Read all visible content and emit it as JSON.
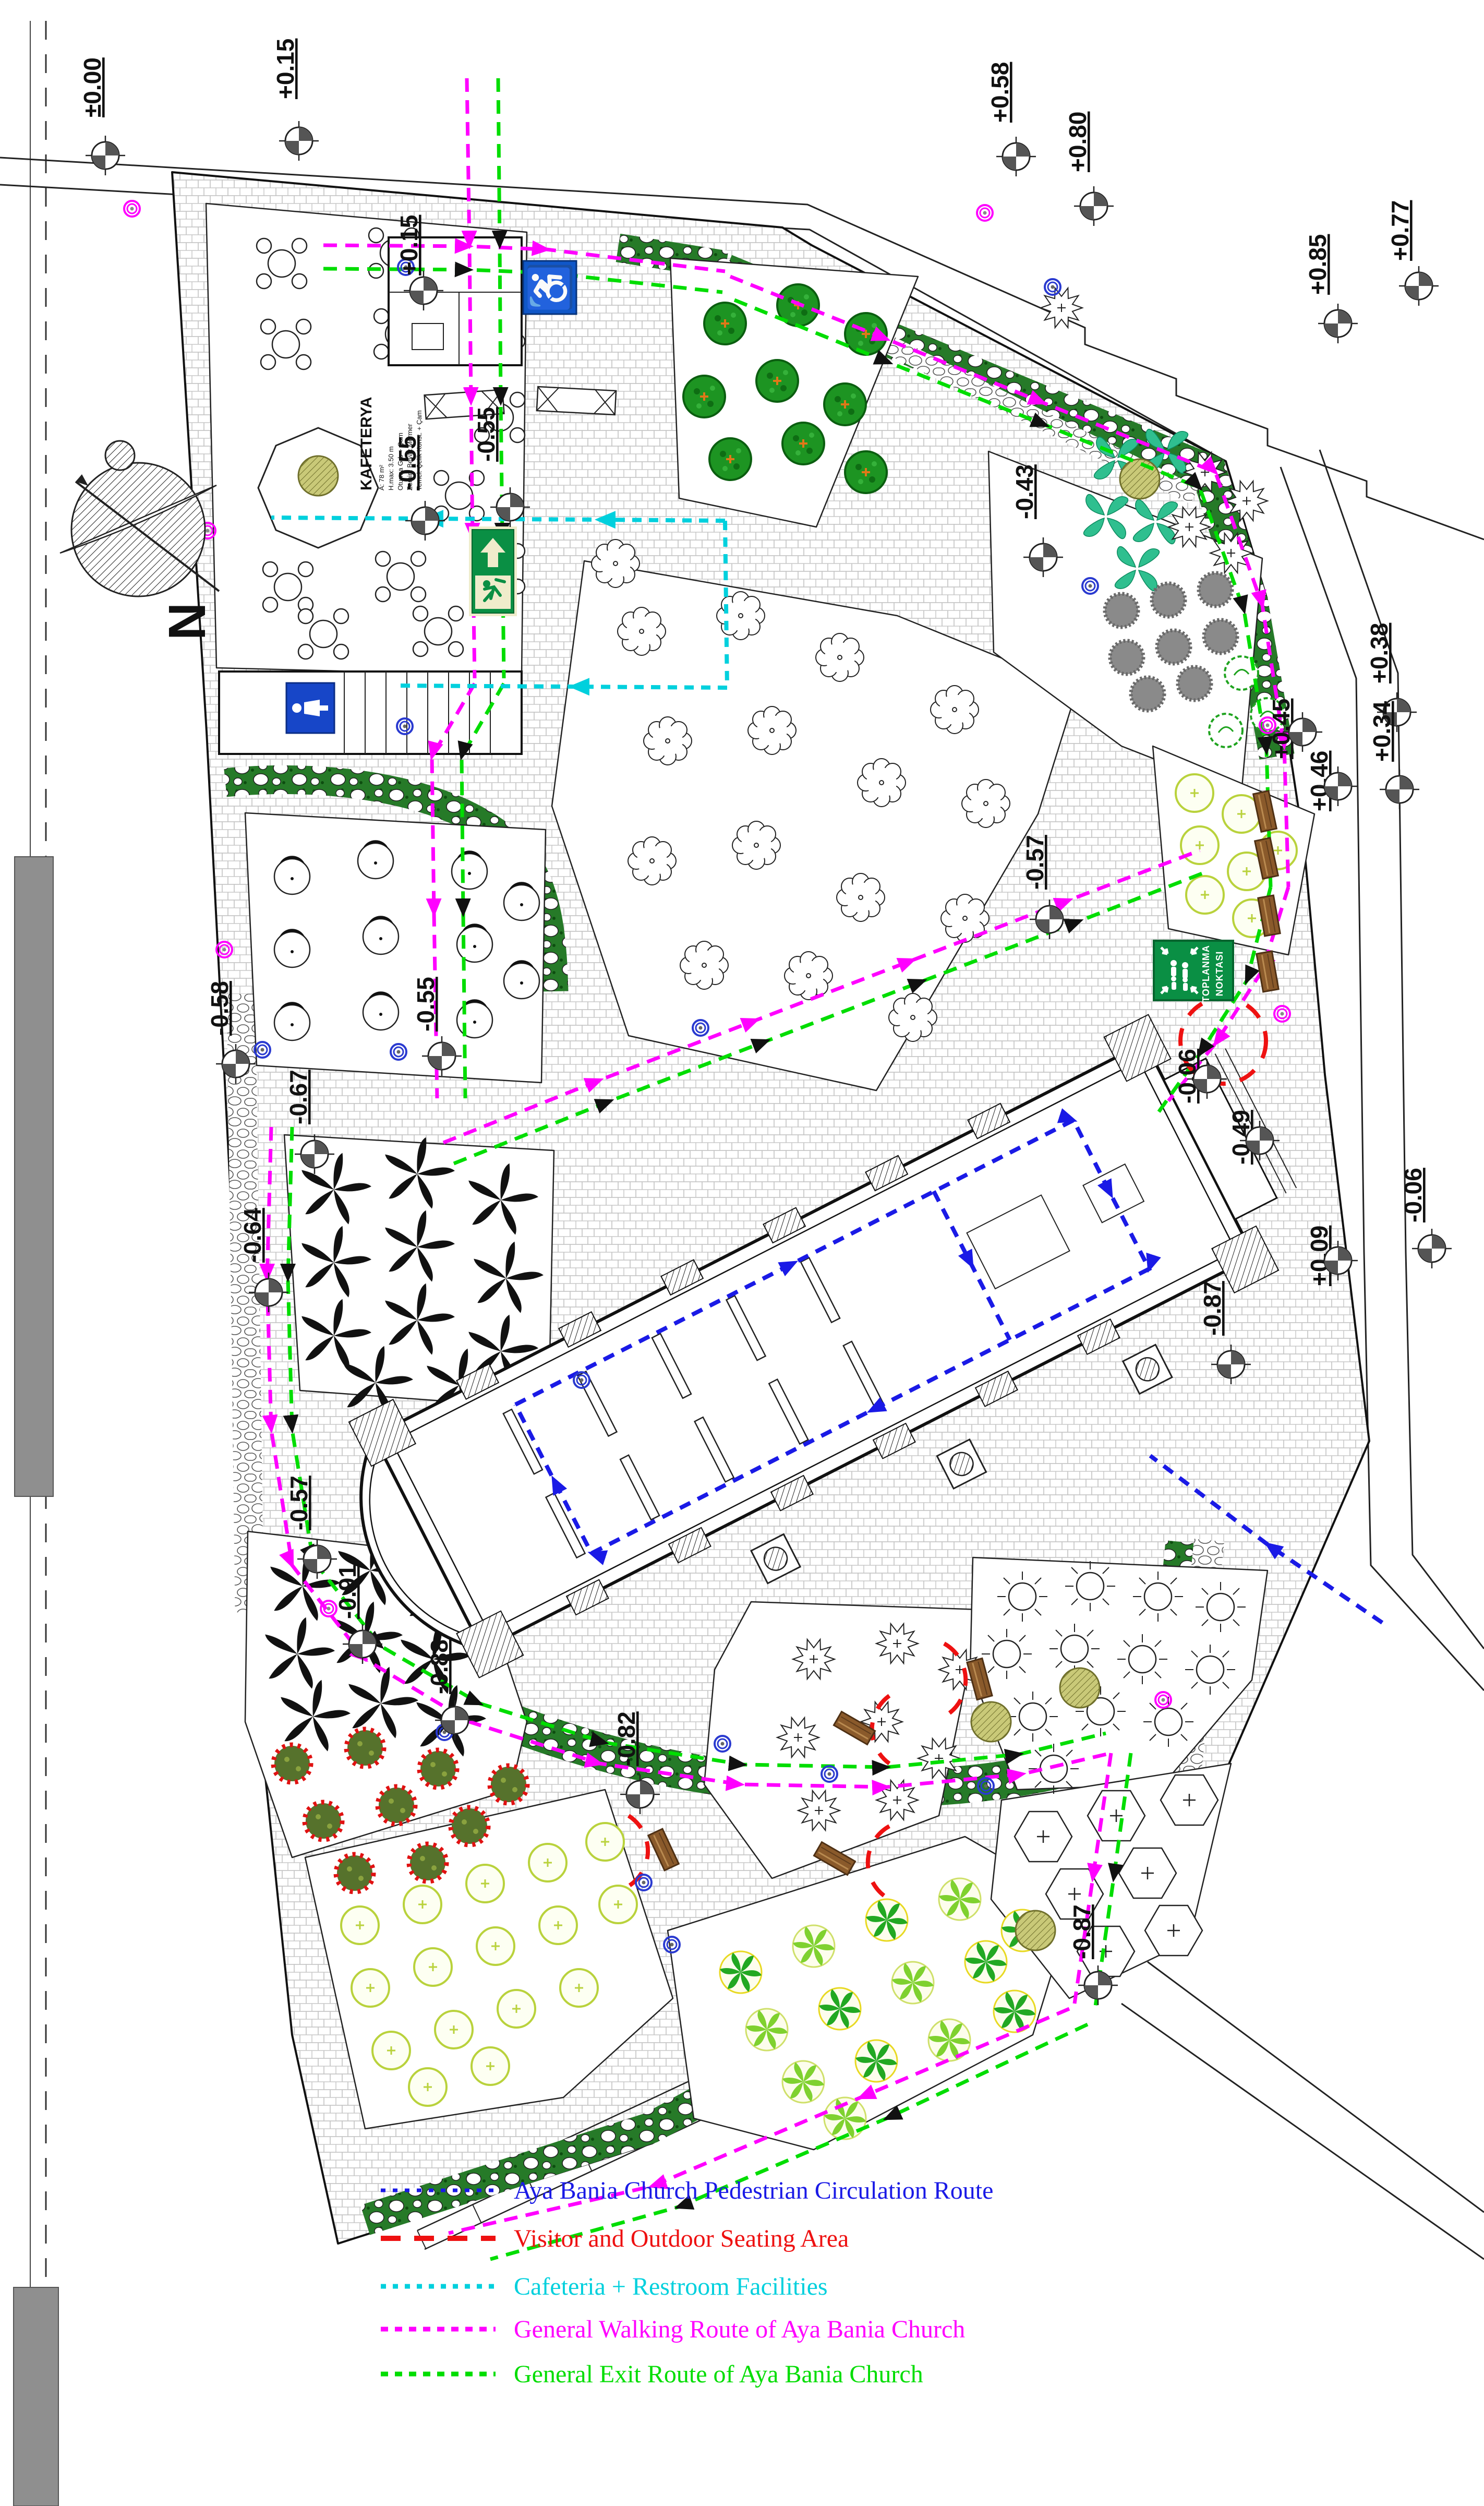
{
  "title": "Aya Bania Church Landscape Site Plan",
  "legend": {
    "items": [
      {
        "label": "Aya Bania Church Pedestrian Circulation Route",
        "color": "#1a1ae6",
        "dash": "dotted"
      },
      {
        "label": "Visitor and Outdoor Seating Area",
        "color": "#ee1111",
        "dash": "dashed"
      },
      {
        "label": "Cafeteria + Restroom Facilities",
        "color": "#00d0dd",
        "dash": "dotted"
      },
      {
        "label": "General Walking Route of Aya Bania Church",
        "color": "#ff00ff",
        "dash": "dotted"
      },
      {
        "label": "General Exit Route of Aya Bania Church",
        "color": "#00dd00",
        "dash": "dotted"
      }
    ]
  },
  "levels": [
    {
      "label": "±0.00"
    },
    {
      "label": "+0.15"
    },
    {
      "label": "+0.15"
    },
    {
      "label": "-0.55"
    },
    {
      "label": "-0.55"
    },
    {
      "label": "-0.43"
    },
    {
      "label": "+0.58"
    },
    {
      "label": "+0.80"
    },
    {
      "label": "+0.85"
    },
    {
      "label": "+0.77"
    },
    {
      "label": "+0.38"
    },
    {
      "label": "+0.34"
    },
    {
      "label": "+0.45"
    },
    {
      "label": "+0.46"
    },
    {
      "label": "-0.57"
    },
    {
      "label": "-0.06"
    },
    {
      "label": "-0.49"
    },
    {
      "label": "+0.09"
    },
    {
      "label": "-0.06"
    },
    {
      "label": "-0.87"
    },
    {
      "label": "-0.58"
    },
    {
      "label": "-0.55"
    },
    {
      "label": "-0.67"
    },
    {
      "label": "-0.64"
    },
    {
      "label": "-0.57"
    },
    {
      "label": "-0.91"
    },
    {
      "label": "-0.88"
    },
    {
      "label": "-0.82"
    },
    {
      "label": "-0.87"
    }
  ],
  "signs": {
    "assembly_point": {
      "line1": "TOPLANMA",
      "line2": "NOKTASI",
      "bg": "#0a8f44"
    },
    "emergency_exit": {
      "bg": "#0a8f44"
    },
    "accessible": {
      "symbol": "♿",
      "bg": "#1057c8"
    },
    "restroom": {
      "bg": "#1746c8"
    }
  },
  "cafeteria": {
    "title": "KAFETERYA",
    "specs": [
      "A: 78 m²",
      "H.max: 3.50 m",
      "Oturma Grb + Çam",
      "Zemin: Beyaz Mermer",
      "Temel: Çelik Konst. + Çam"
    ]
  },
  "compass": {
    "north": "N"
  }
}
